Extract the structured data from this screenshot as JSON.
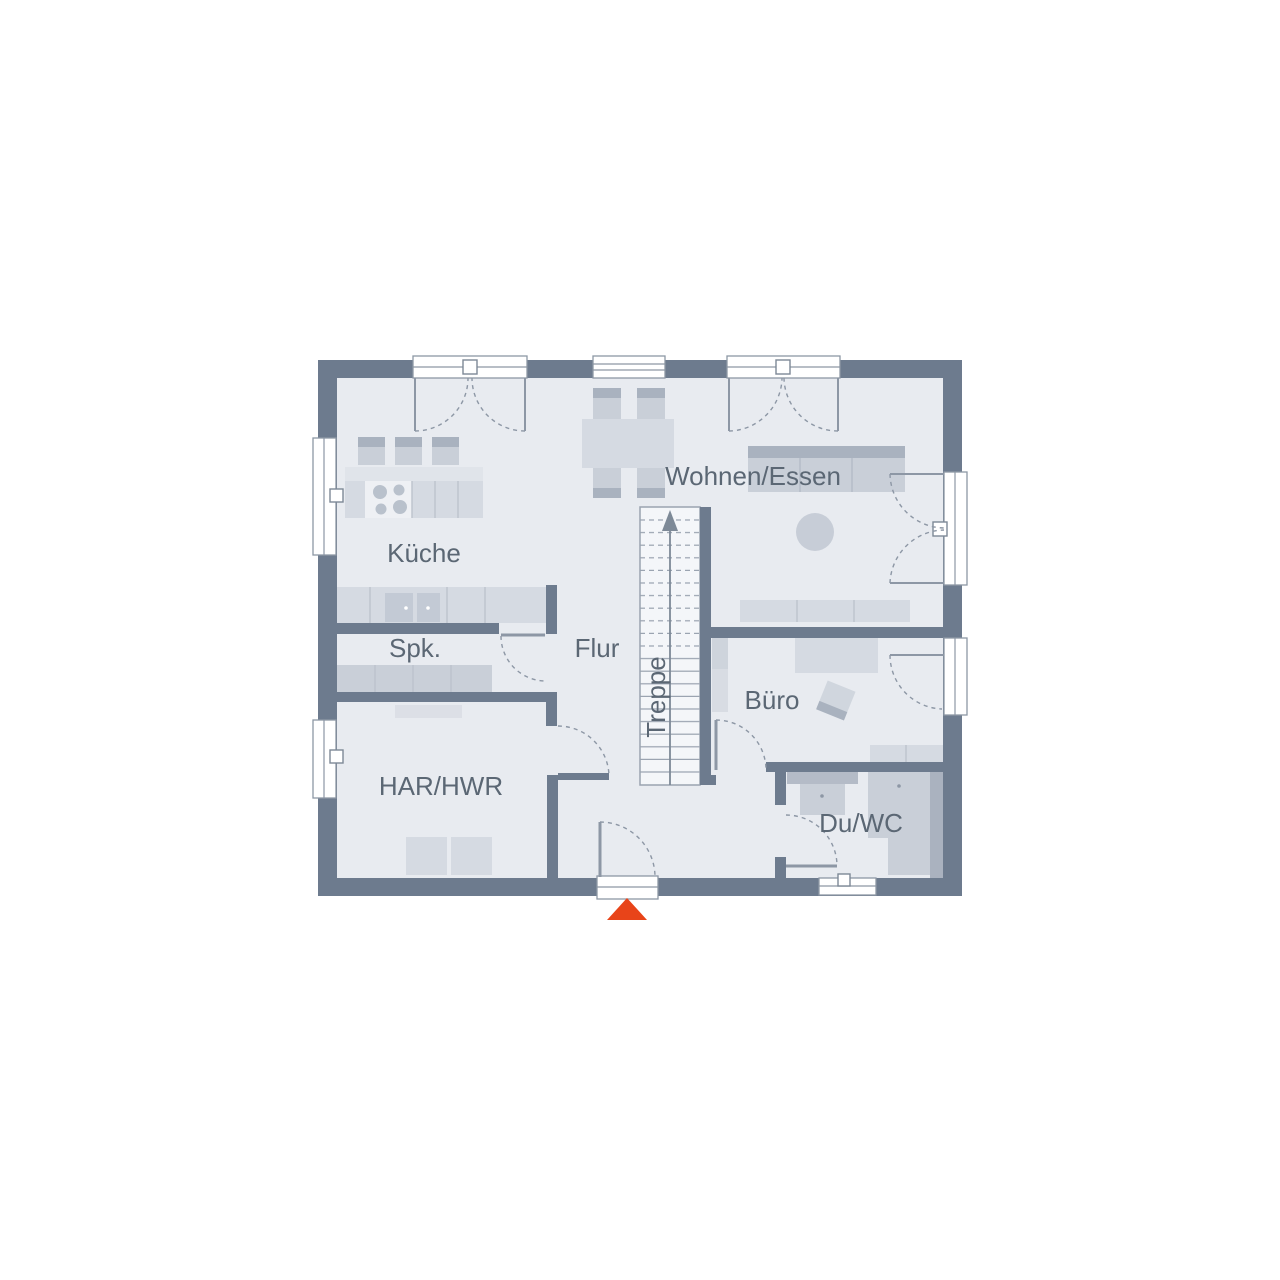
{
  "floor_plan": {
    "labels": {
      "kueche": "Küche",
      "spk": "Spk.",
      "flur": "Flur",
      "treppe": "Treppe",
      "wohnen_essen": "Wohnen/Essen",
      "buero": "Büro",
      "har_hwr": "HAR/HWR",
      "du_wc": "Du/WC"
    },
    "colors": {
      "wall": "#6d7b8e",
      "floor": "#e8ebf0",
      "furniture_light": "#d5dae2",
      "furniture_mid": "#c9cfd8",
      "furniture_dark": "#a9b2bf",
      "line": "#8d97a5",
      "label_text": "#5b6774",
      "stairs_fill": "#f4f6f9",
      "entrance_marker": "#e84419"
    }
  }
}
